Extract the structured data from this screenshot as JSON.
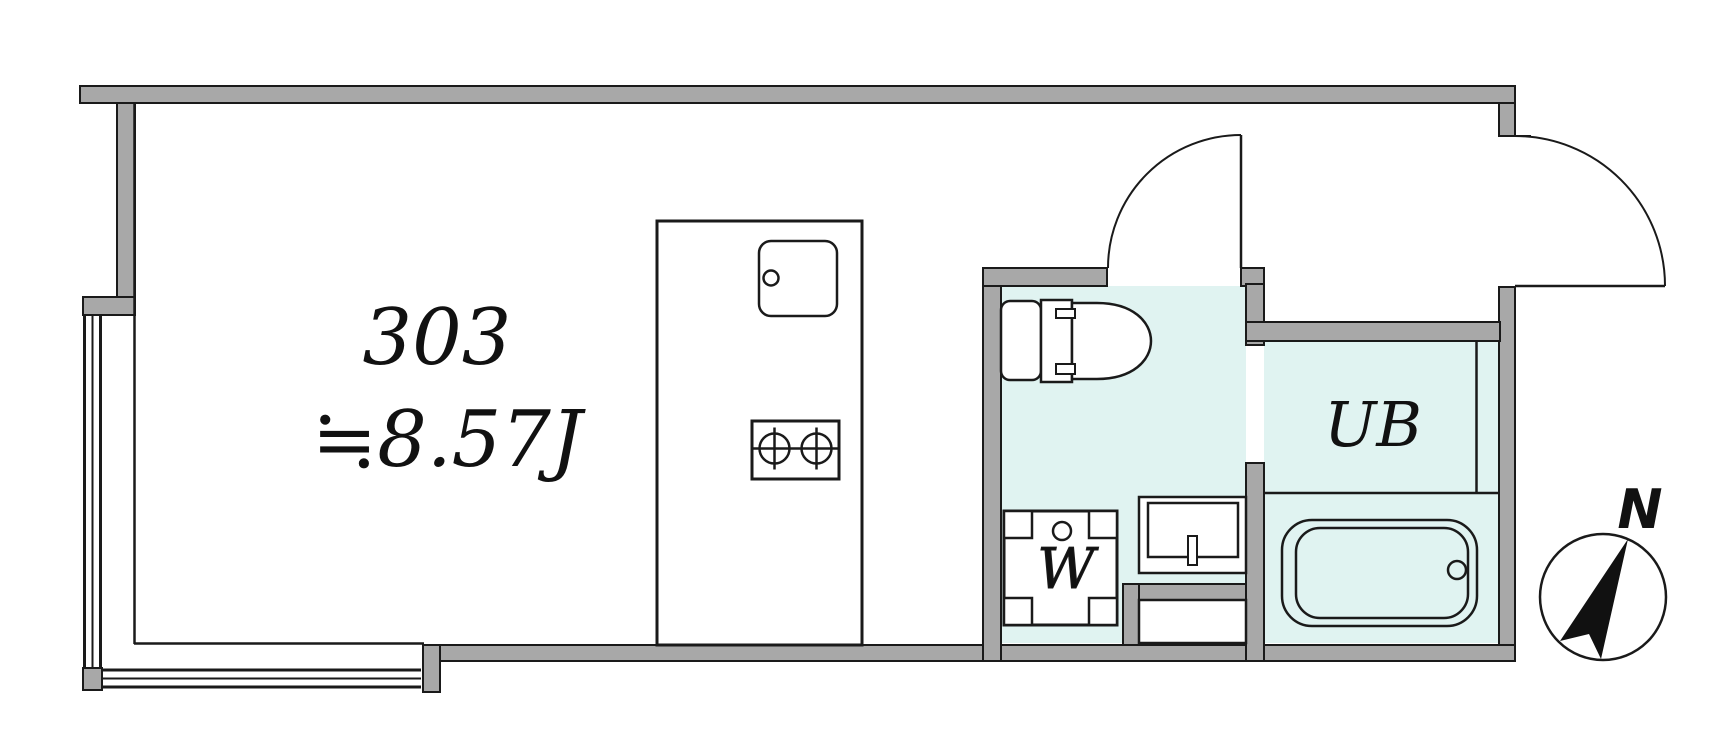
{
  "labels": {
    "room_number": "303",
    "room_area": "≒8.57J",
    "washer": "W",
    "unit_bath": "UB",
    "compass_north": "N"
  },
  "colors": {
    "wall_gray": "#a8a8a8",
    "wet_area_floor": "#e0f3f1",
    "outline_black": "#1a1a1a",
    "background": "#ffffff"
  }
}
